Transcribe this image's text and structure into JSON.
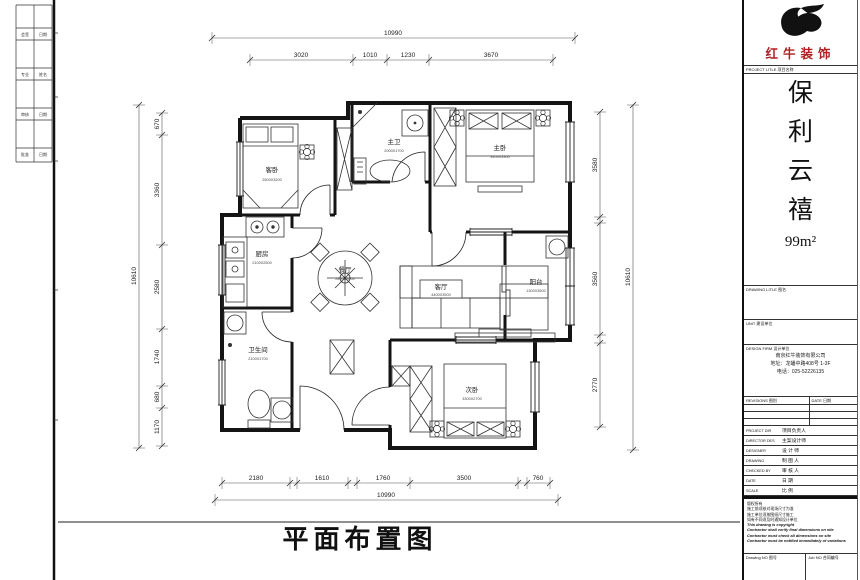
{
  "plan": {
    "title": "平面布置图",
    "rooms": {
      "guest": {
        "name": "客卧",
        "size": "2500X3200"
      },
      "mbath": {
        "name": "主卫",
        "size": "2000X1700"
      },
      "master": {
        "name": "主卧",
        "size": "3400X3300"
      },
      "kitchen": {
        "name": "厨房",
        "size": "2100X2500"
      },
      "dining": {
        "name": "餐厅",
        "size": "2400X2600"
      },
      "living": {
        "name": "客厅",
        "size": "4400X3500"
      },
      "balcony": {
        "name": "阳台",
        "size": "1300X3500"
      },
      "wc": {
        "name": "卫生间",
        "size": "2100X1700"
      },
      "second": {
        "name": "次卧",
        "size": "3300X2700"
      }
    },
    "dims": {
      "top": {
        "overall": "10990",
        "segs": [
          "3020",
          "1010",
          "1230",
          "3670"
        ]
      },
      "bottom": {
        "overall": "10990",
        "segs": [
          "2180",
          "1610",
          "1760",
          "3500",
          "760"
        ]
      },
      "left": {
        "overall": "10610",
        "segs": [
          "670",
          "3360",
          "2580",
          "1740",
          "680",
          "1170"
        ]
      },
      "right": {
        "overall": "10610",
        "segs": [
          "3580",
          "3560",
          "2770"
        ]
      }
    }
  },
  "edge": {
    "rows": [
      {
        "a": "会签",
        "b": "日期"
      },
      {
        "a": "专业",
        "b": "姓名"
      },
      {
        "a": "审核",
        "b": "日期"
      },
      {
        "a": "批准",
        "b": "日期"
      }
    ]
  },
  "tb": {
    "brand": "红牛装饰",
    "project_label": "PROJECT LITLE 项目名称",
    "pn": [
      "保",
      "利",
      "云",
      "禧"
    ],
    "area": "99m²",
    "drawing_label": "DRAWING LITLE 图名",
    "unit_label": "UNIT 建设单位",
    "firm_label": "DESIGN FIRM 设计单位",
    "firm_lines": [
      "南京红牛装饰有限公司",
      "地址：龙蟠中路408号 1-3F",
      "电话：025-52226135"
    ],
    "rev_label": "REVISIONS 图别",
    "date_label": "DATE 日期",
    "rows": [
      {
        "en": "PROJECT DIR",
        "zh": "项目负责人"
      },
      {
        "en": "DIRECTOR DES",
        "zh": "主案设计师"
      },
      {
        "en": "DESIGNER",
        "zh": "设 计 师"
      },
      {
        "en": "DRAWING",
        "zh": "制 图 人"
      },
      {
        "en": "CHECKED BY",
        "zh": "审 核 人"
      },
      {
        "en": "DATE",
        "zh": "日  期"
      },
      {
        "en": "SCALE",
        "zh": "比  例"
      }
    ],
    "notes": [
      "版权所有",
      "施工前须核对现场尺寸为准",
      "施工单位须按图纸尺寸施工",
      "如有不同须及时通知设计单位",
      "This drawing is copyright",
      "Contractor shall verify final dimensions on site",
      "Contractor must check all dimensions on site",
      "Contractor must be notified immediately of variations"
    ],
    "drawing_no_label": "Drawing NO 图号",
    "job_no_label": "Job NO 合同编号"
  }
}
